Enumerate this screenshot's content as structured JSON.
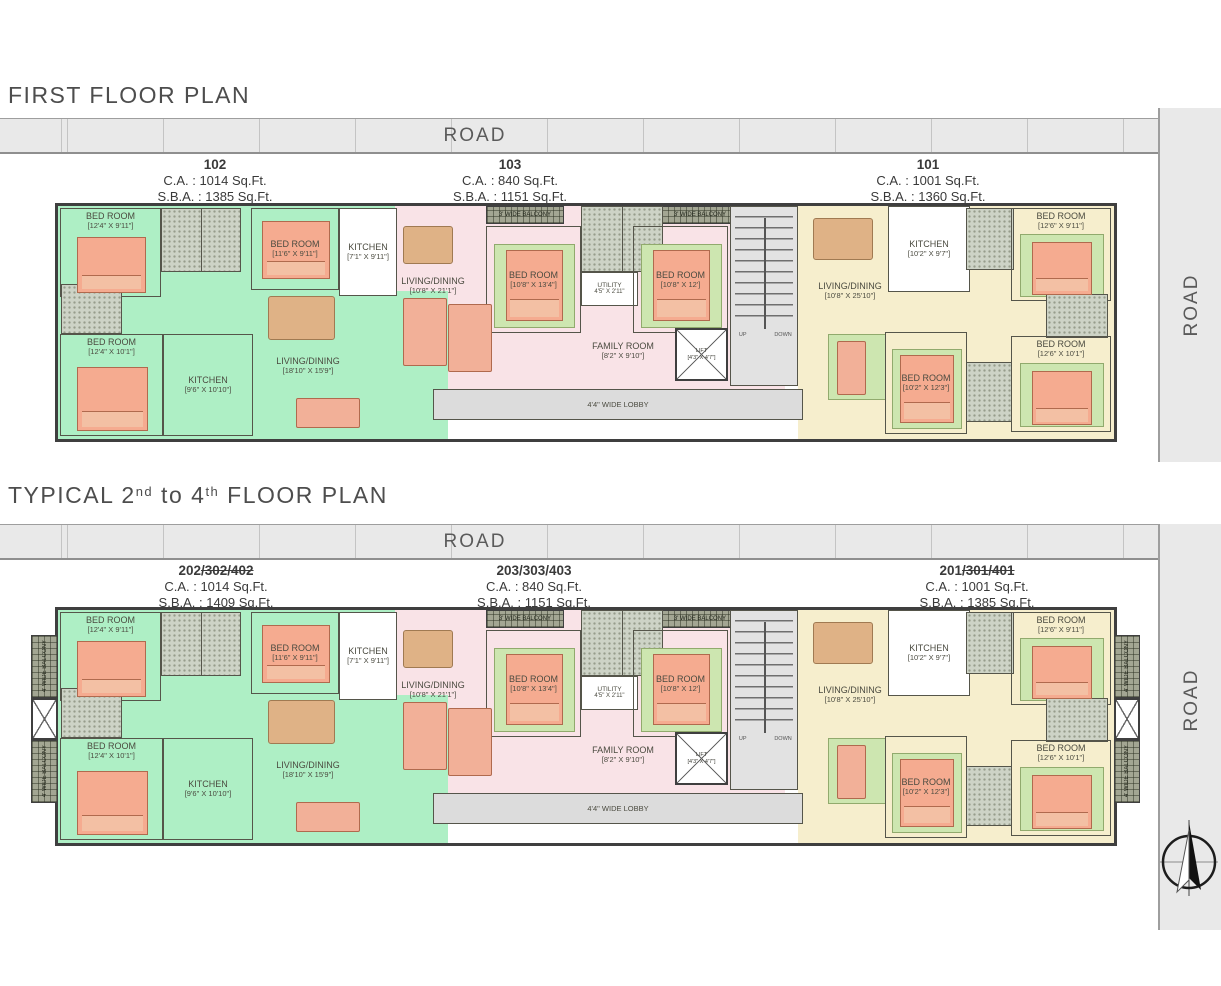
{
  "palette": {
    "unit_green": "#aeefc5",
    "unit_pink": "#f9e3e7",
    "unit_cream": "#f6eecd",
    "road_gray": "#e9e9e9",
    "wall_dark": "#3f3f3f",
    "stair_gray": "#e2e2e2",
    "furniture_salmon": "#f5ab90"
  },
  "plans": [
    {
      "title": {
        "pre": "FIRST FLOOR PLAN",
        "sup1": "",
        "mid": "",
        "sup2": "",
        "post": ""
      },
      "road_top": "ROAD",
      "road_side": "ROAD",
      "units": [
        {
          "number": "102",
          "number_struck": "",
          "ca": "C.A. : 1014 Sq.Ft.",
          "sba": "S.B.A. : 1385 Sq.Ft."
        },
        {
          "number": "103",
          "number_struck": "",
          "ca": "C.A. : 840 Sq.Ft.",
          "sba": "S.B.A. : 1151 Sq.Ft."
        },
        {
          "number": "101",
          "number_struck": "",
          "ca": "C.A. : 1001 Sq.Ft.",
          "sba": "S.B.A. : 1360 Sq.Ft."
        }
      ]
    },
    {
      "title": {
        "pre": "TYPICAL 2",
        "sup1": "nd",
        "mid": " to 4",
        "sup2": "th",
        "post": " FLOOR PLAN"
      },
      "road_top": "ROAD",
      "road_side": "ROAD",
      "units": [
        {
          "number": "202",
          "number_struck": "/302/402",
          "ca": "C.A. : 1014 Sq.Ft.",
          "sba": "S.B.A. : 1409 Sq.Ft."
        },
        {
          "number": "203/303/403",
          "number_struck": "",
          "ca": "C.A. : 840 Sq.Ft.",
          "sba": "S.B.A. : 1151 Sq.Ft."
        },
        {
          "number": "201",
          "number_struck": "/301/401",
          "ca": "C.A. : 1001 Sq.Ft.",
          "sba": "S.B.A. : 1385 Sq.Ft."
        }
      ]
    }
  ],
  "rooms": {
    "bed_12_4_9_11": {
      "name": "BED ROOM",
      "dim": "[12'4\" X 9'11\"]"
    },
    "bed_11_6_9_11": {
      "name": "BED ROOM",
      "dim": "[11'6\" X 9'11\"]"
    },
    "kitchen_7_1_9_11": {
      "name": "KITCHEN",
      "dim": "[7'1\" X 9'11\"]"
    },
    "bed_12_4_10_1": {
      "name": "BED ROOM",
      "dim": "[12'4\" X 10'1\"]"
    },
    "kitchen_9_6_10_10": {
      "name": "KITCHEN",
      "dim": "[9'6\" X 10'10\"]"
    },
    "living_18_10_15_9": {
      "name": "LIVING/DINING",
      "dim": "[18'10\" X 15'9\"]"
    },
    "living_10_8_21_1": {
      "name": "LIVING/DINING",
      "dim": "[10'8\" X 21'1\"]"
    },
    "bed_10_8_13_4": {
      "name": "BED ROOM",
      "dim": "[10'8\" X 13'4\"]"
    },
    "utility_4_5_2_11": {
      "name": "UTILITY",
      "dim": "4'5\" X 2'11\""
    },
    "bed_10_8_12": {
      "name": "BED ROOM",
      "dim": "[10'8\" X 12']"
    },
    "family_8_2_9_10": {
      "name": "FAMILY ROOM",
      "dim": "[8'2\" X 9'10\"]"
    },
    "lift_4_3_4_7": {
      "name": "LIFT",
      "dim": "[4'3\" X 4'7\"]"
    },
    "lobby_4_4": {
      "name": "4'4\" WIDE LOBBY"
    },
    "balcony_3": {
      "name": "3' WIDE BALCONY"
    },
    "balcony_4": {
      "name": "4' WIDE BALCONY"
    },
    "living_10_8_25_10": {
      "name": "LIVING/DINING",
      "dim": "[10'8\" X 25'10\"]"
    },
    "kitchen_10_2_9_7": {
      "name": "KITCHEN",
      "dim": "[10'2\" X 9'7\"]"
    },
    "bed_12_6_9_11": {
      "name": "BED ROOM",
      "dim": "[12'6\" X 9'11\"]"
    },
    "bed_10_2_12_3": {
      "name": "BED ROOM",
      "dim": "[10'2\" X 12'3\"]"
    },
    "bed_12_6_10_1": {
      "name": "BED ROOM",
      "dim": "[12'6\" X 10'1\"]"
    },
    "stairs": {
      "up": "UP",
      "down": "DOWN"
    }
  }
}
